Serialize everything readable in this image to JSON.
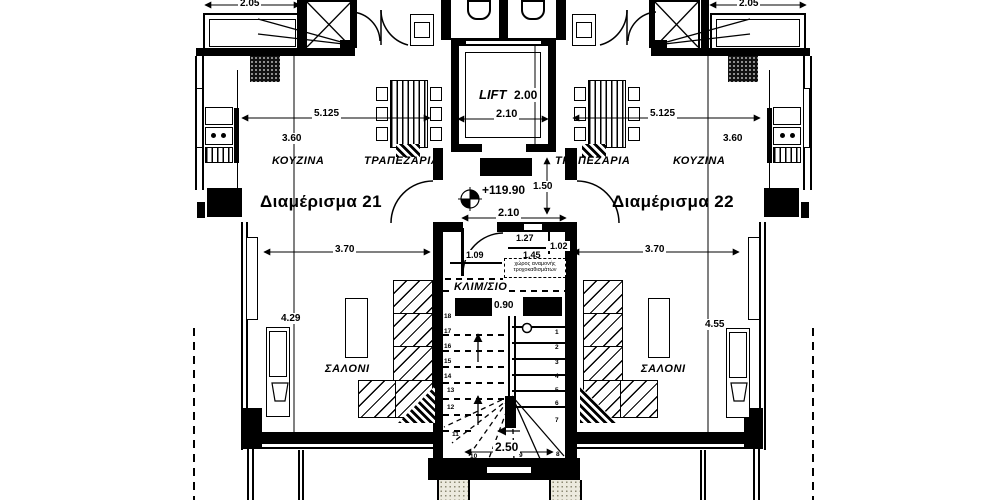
{
  "apartments": {
    "left": {
      "name": "Διαμέρισμα 21",
      "kitchen_label": "ΚΟΥΖΙΝΑ",
      "dining_label": "ΤΡΑΠΕΖΑΡΙΑ",
      "living_label": "ΣΑΛΟΝΙ",
      "dims": {
        "counter_width": "2.05",
        "overall_width": "5.125",
        "kitchen_depth": "3.60",
        "living_width": "3.70",
        "living_depth": "4.29"
      }
    },
    "right": {
      "name": "Διαμέρισμα 22",
      "kitchen_label": "ΚΟΥΖΙΝΑ",
      "dining_label": "ΤΡΑΠΕΖΑΡΙΑ",
      "living_label": "ΣΑΛΟΝΙ",
      "dims": {
        "counter_width": "2.05",
        "overall_width": "5.125",
        "kitchen_depth": "3.60",
        "living_width": "3.70",
        "living_depth": "4.55"
      }
    }
  },
  "core": {
    "lift": {
      "label": "LIFT",
      "depth": "2.00",
      "width": "2.10"
    },
    "entry": {
      "level": "+119.90",
      "side_dim": "1.50",
      "width": "2.10"
    },
    "vestibule": {
      "dim_top": "1.27",
      "dim_right": "1.02",
      "dim_left": "1.09",
      "dim_mid": "1.45",
      "note_line1": "χώρος αναμονής",
      "note_line2": "τροχοκαθισμάτων"
    },
    "stairs": {
      "label": "ΚΛΙΜ/ΣΙΟ",
      "width": "0.90",
      "run": "2.50",
      "left_numbers": [
        "18",
        "17",
        "16",
        "15",
        "14",
        "13",
        "12",
        "11",
        "10"
      ],
      "right_numbers": [
        "1",
        "2",
        "3",
        "4",
        "5",
        "6",
        "7",
        "8",
        "9"
      ]
    }
  },
  "colors": {
    "ink": "#000000",
    "paper": "#ffffff"
  }
}
